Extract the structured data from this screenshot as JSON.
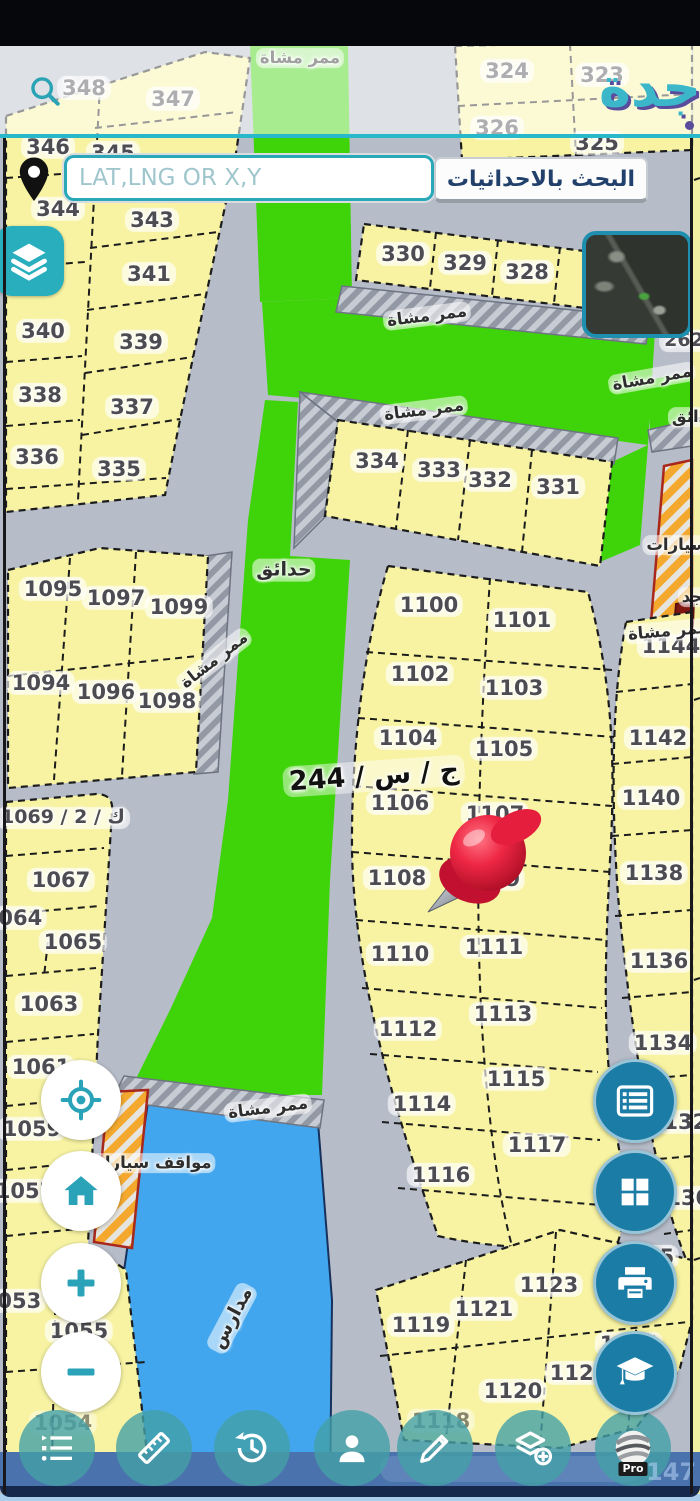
{
  "app": {
    "logo_text": "جدة",
    "colors": {
      "accent_teal": "#2aa7b8",
      "fab_blue": "#1b7ca6",
      "parcel_yellow": "#f7f3a2",
      "park_green": "#3fd409",
      "water_blue": "#42a6ee",
      "hatch_orange": "#f4a92e",
      "pin_red": "#e2243e",
      "footer_navy": "#16294d",
      "button_text_navy": "#21406c"
    }
  },
  "header": {
    "search_placeholder": "LAT,LNG OR X,Y",
    "coords_button_label": "البحث بالاحداثيات"
  },
  "toolbar": {
    "pro_label": "Pro",
    "icons": [
      "bullet-list",
      "ruler",
      "history",
      "person",
      "pencil",
      "layers-plus",
      "earth-pro"
    ]
  },
  "fabs": {
    "right_icons": [
      "parcel-list",
      "grid",
      "printer",
      "graduation-cap"
    ],
    "left_icons": [
      "locate",
      "home",
      "zoom-in",
      "zoom-out"
    ],
    "top_icons": [
      "layers",
      "satellite-preview"
    ]
  },
  "map": {
    "region_label": "ج / س / 244",
    "watermark": "147",
    "parcels": [
      {
        "n": "348",
        "x": 84,
        "y": 88
      },
      {
        "n": "347",
        "x": 173,
        "y": 99
      },
      {
        "n": "324",
        "x": 507,
        "y": 71
      },
      {
        "n": "323",
        "x": 602,
        "y": 75
      },
      {
        "n": "326",
        "x": 497,
        "y": 128
      },
      {
        "n": "325",
        "x": 597,
        "y": 143
      },
      {
        "n": "346",
        "x": 48,
        "y": 147
      },
      {
        "n": "345",
        "x": 113,
        "y": 153
      },
      {
        "n": "344",
        "x": 58,
        "y": 209
      },
      {
        "n": "343",
        "x": 152,
        "y": 220
      },
      {
        "n": "341",
        "x": 149,
        "y": 274
      },
      {
        "n": "340",
        "x": 43,
        "y": 331
      },
      {
        "n": "339",
        "x": 141,
        "y": 342
      },
      {
        "n": "338",
        "x": 40,
        "y": 395
      },
      {
        "n": "337",
        "x": 132,
        "y": 407
      },
      {
        "n": "336",
        "x": 37,
        "y": 457
      },
      {
        "n": "335",
        "x": 119,
        "y": 469
      },
      {
        "n": "330",
        "x": 403,
        "y": 254
      },
      {
        "n": "329",
        "x": 465,
        "y": 263
      },
      {
        "n": "328",
        "x": 527,
        "y": 272
      },
      {
        "n": "334",
        "x": 377,
        "y": 461
      },
      {
        "n": "333",
        "x": 439,
        "y": 470
      },
      {
        "n": "332",
        "x": 490,
        "y": 480
      },
      {
        "n": "331",
        "x": 558,
        "y": 487
      },
      {
        "n": "262",
        "x": 684,
        "y": 341,
        "s": 19
      },
      {
        "n": "1095",
        "x": 53,
        "y": 589
      },
      {
        "n": "1097",
        "x": 116,
        "y": 598
      },
      {
        "n": "1099",
        "x": 179,
        "y": 607
      },
      {
        "n": "1094",
        "x": 41,
        "y": 683
      },
      {
        "n": "1096",
        "x": 106,
        "y": 692
      },
      {
        "n": "1098",
        "x": 167,
        "y": 701
      },
      {
        "n": "1100",
        "x": 429,
        "y": 605
      },
      {
        "n": "1101",
        "x": 522,
        "y": 620
      },
      {
        "n": "1102",
        "x": 420,
        "y": 674
      },
      {
        "n": "1103",
        "x": 514,
        "y": 688
      },
      {
        "n": "1104",
        "x": 408,
        "y": 738
      },
      {
        "n": "1105",
        "x": 504,
        "y": 749
      },
      {
        "n": "1106",
        "x": 400,
        "y": 803
      },
      {
        "n": "1107",
        "x": 495,
        "y": 814
      },
      {
        "n": "1108",
        "x": 397,
        "y": 878
      },
      {
        "n": "1109",
        "x": 491,
        "y": 879
      },
      {
        "n": "1110",
        "x": 400,
        "y": 954
      },
      {
        "n": "1111",
        "x": 494,
        "y": 947
      },
      {
        "n": "1112",
        "x": 408,
        "y": 1029
      },
      {
        "n": "1113",
        "x": 503,
        "y": 1014
      },
      {
        "n": "1114",
        "x": 422,
        "y": 1104
      },
      {
        "n": "1115",
        "x": 516,
        "y": 1079
      },
      {
        "n": "1116",
        "x": 441,
        "y": 1175
      },
      {
        "n": "1117",
        "x": 537,
        "y": 1145
      },
      {
        "n": "1144",
        "x": 671,
        "y": 646
      },
      {
        "n": "1142",
        "x": 658,
        "y": 738
      },
      {
        "n": "1140",
        "x": 651,
        "y": 798
      },
      {
        "n": "1138",
        "x": 654,
        "y": 873
      },
      {
        "n": "1136",
        "x": 659,
        "y": 961
      },
      {
        "n": "1134",
        "x": 663,
        "y": 1043
      },
      {
        "n": "1132",
        "x": 678,
        "y": 1122
      },
      {
        "n": "1130",
        "x": 681,
        "y": 1198
      },
      {
        "n": "ك / 2 / 1069",
        "x": 63,
        "y": 818,
        "s": 19
      },
      {
        "n": "1067",
        "x": 61,
        "y": 880
      },
      {
        "n": "1064",
        "x": 13,
        "y": 918
      },
      {
        "n": "1065",
        "x": 73,
        "y": 942
      },
      {
        "n": "1063",
        "x": 49,
        "y": 1004
      },
      {
        "n": "1061",
        "x": 41,
        "y": 1067
      },
      {
        "n": "1059",
        "x": 32,
        "y": 1129
      },
      {
        "n": "1057",
        "x": 25,
        "y": 1191
      },
      {
        "n": "1053",
        "x": 12,
        "y": 1301
      },
      {
        "n": "1055",
        "x": 79,
        "y": 1331
      },
      {
        "n": "1054",
        "x": 63,
        "y": 1423,
        "o": 0.6
      },
      {
        "n": "1119",
        "x": 421,
        "y": 1325
      },
      {
        "n": "1121",
        "x": 484,
        "y": 1309
      },
      {
        "n": "1123",
        "x": 549,
        "y": 1285
      },
      {
        "n": "1125",
        "x": 645,
        "y": 1257
      },
      {
        "n": "1120",
        "x": 513,
        "y": 1391
      },
      {
        "n": "1122",
        "x": 579,
        "y": 1373
      },
      {
        "n": "1124",
        "x": 629,
        "y": 1344
      },
      {
        "n": "1118",
        "x": 441,
        "y": 1421,
        "o": 0.65
      }
    ],
    "area_labels": [
      {
        "t": "ممر مشاة",
        "x": 300,
        "y": 58,
        "r": 0
      },
      {
        "t": "ممر مشاة",
        "x": 427,
        "y": 316,
        "r": -7
      },
      {
        "t": "ممر مشاة",
        "x": 424,
        "y": 410,
        "r": -7
      },
      {
        "t": "ممر مشاة",
        "x": 652,
        "y": 378,
        "r": -10
      },
      {
        "t": "حدائق",
        "x": 696,
        "y": 417,
        "r": 0
      },
      {
        "t": "حدائق",
        "x": 284,
        "y": 570,
        "r": 0,
        "s": 19
      },
      {
        "t": "ممر مشاة",
        "x": 214,
        "y": 660,
        "r": -38
      },
      {
        "t": "مواقف سيارات",
        "x": 708,
        "y": 545,
        "r": 0
      },
      {
        "t": "مسجد",
        "x": 706,
        "y": 597,
        "r": 0
      },
      {
        "t": "ممر مشاة",
        "x": 668,
        "y": 631,
        "r": -5
      },
      {
        "t": "ممر مشاة",
        "x": 268,
        "y": 1108,
        "r": -7
      },
      {
        "t": "مواقف سيارات",
        "x": 150,
        "y": 1163,
        "r": 0
      },
      {
        "t": "مدارس",
        "x": 232,
        "y": 1318,
        "r": -62,
        "s": 19
      }
    ]
  }
}
